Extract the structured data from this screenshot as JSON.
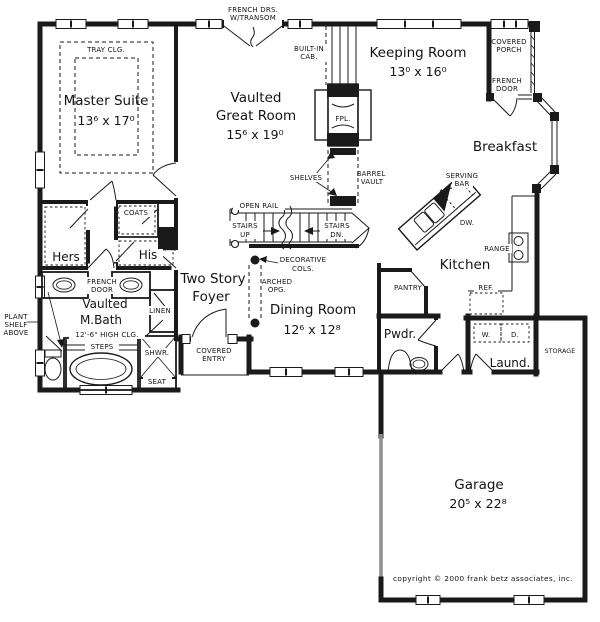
{
  "plan": {
    "rooms": {
      "master_suite": {
        "name": "Master Suite",
        "dims": "13⁶  x  17⁰"
      },
      "great_room": {
        "line1": "Vaulted",
        "line2": "Great Room",
        "dims": "15⁶  x  19⁰"
      },
      "keeping_room": {
        "name": "Keeping Room",
        "dims": "13⁰  x  16⁰"
      },
      "breakfast": {
        "name": "Breakfast"
      },
      "kitchen": {
        "name": "Kitchen"
      },
      "dining_room": {
        "name": "Dining Room",
        "dims": "12⁶  x  12⁸"
      },
      "foyer": {
        "line1": "Two Story",
        "line2": "Foyer"
      },
      "master_bath": {
        "line1": "Vaulted",
        "line2": "M.Bath",
        "ceiling": "12'-6\" HIGH CLG."
      },
      "garage": {
        "name": "Garage",
        "dims": "20⁵  x  22⁸"
      },
      "powder": {
        "name": "Pwdr."
      },
      "laundry": {
        "name": "Laund."
      },
      "storage": {
        "name": "STORAGE"
      },
      "hers_closet": {
        "name": "Hers"
      },
      "his_closet": {
        "name": "His"
      },
      "covered_porch": {
        "line1": "COVERED",
        "line2": "PORCH"
      },
      "covered_entry": {
        "line1": "COVERED",
        "line2": "ENTRY"
      }
    },
    "labels": {
      "french_doors_transom": {
        "line1": "FRENCH DRS.",
        "line2": "W/TRANSOM"
      },
      "tray_ceiling": "TRAY CLG.",
      "built_in_cabinet": {
        "line1": "BUILT-IN",
        "line2": "CAB."
      },
      "porch_french_door": {
        "line1": "FRENCH",
        "line2": "DOOR"
      },
      "fireplace": "FPL.",
      "shelves": "SHELVES",
      "barrel_vault": {
        "line1": "BARREL",
        "line2": "VAULT"
      },
      "serving_bar": {
        "line1": "SERVING",
        "line2": "BAR"
      },
      "dishwasher": "DW.",
      "range": "RANGE",
      "refrigerator": "REF.",
      "pantry": "PANTRY",
      "open_rail": "OPEN RAIL",
      "stairs_up": {
        "line1": "STAIRS",
        "line2": "UP"
      },
      "stairs_down": {
        "line1": "STAIRS",
        "line2": "DN."
      },
      "decorative_cols": {
        "line1": "DECORATIVE",
        "line2": "COLS."
      },
      "arched_opening": {
        "line1": "ARCHED",
        "line2": "OPG."
      },
      "coats": "COATS",
      "bath_french_door": {
        "line1": "FRENCH",
        "line2": "DOOR"
      },
      "linen": "LINEN",
      "plant_shelf": {
        "line1": "PLANT",
        "line2": "SHELF",
        "line3": "ABOVE"
      },
      "steps": "STEPS",
      "shower": "SHWR.",
      "seat": "SEAT",
      "washer": "W.",
      "dryer": "D."
    },
    "footer": {
      "copyright": "copyright © 2000 frank betz associates, inc."
    },
    "colors": {
      "ink": "#1a1a1a",
      "paper": "#ffffff",
      "muted_wall": "#8f8f8f"
    }
  }
}
